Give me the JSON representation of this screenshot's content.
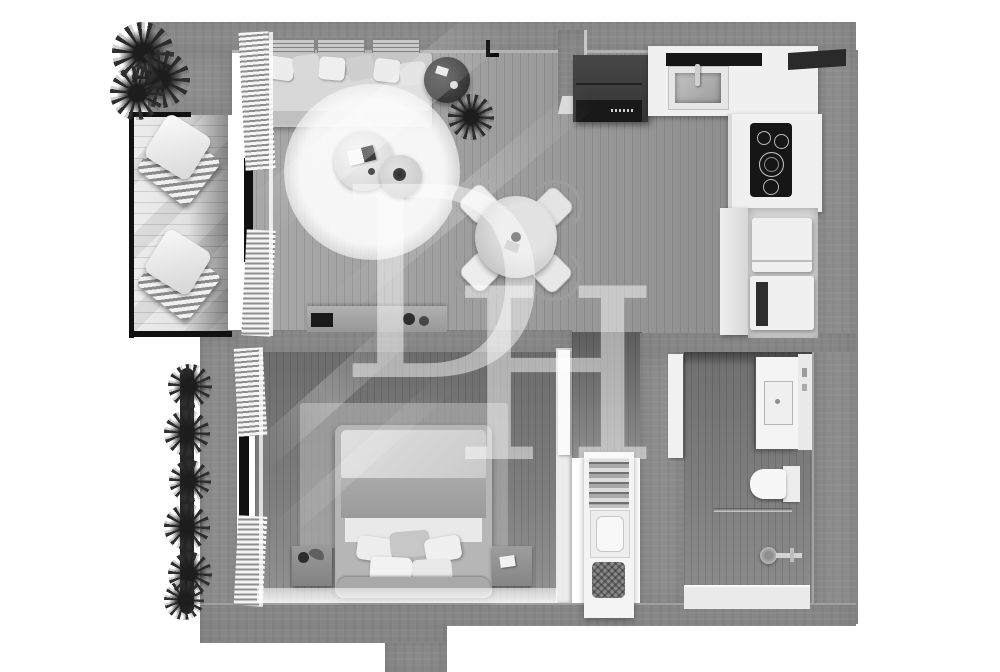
{
  "watermark": {
    "letter_d": "D",
    "letter_h": "H",
    "logo_text": "DH"
  },
  "palette": {
    "background": "#ffffff",
    "wall": "#8e8e8e",
    "wall_edge": "#b3b3b3",
    "furniture_white": "#f0f0f0",
    "furniture_gray": "#c4c4c4",
    "appliance_dark": "#333333",
    "cooktop_black": "#161616",
    "railing_black": "#111111",
    "plant_dark": "#2e2e2e",
    "rug_light": "#f5f5f5",
    "watermark_color": "rgba(255,255,255,0.48)"
  }
}
